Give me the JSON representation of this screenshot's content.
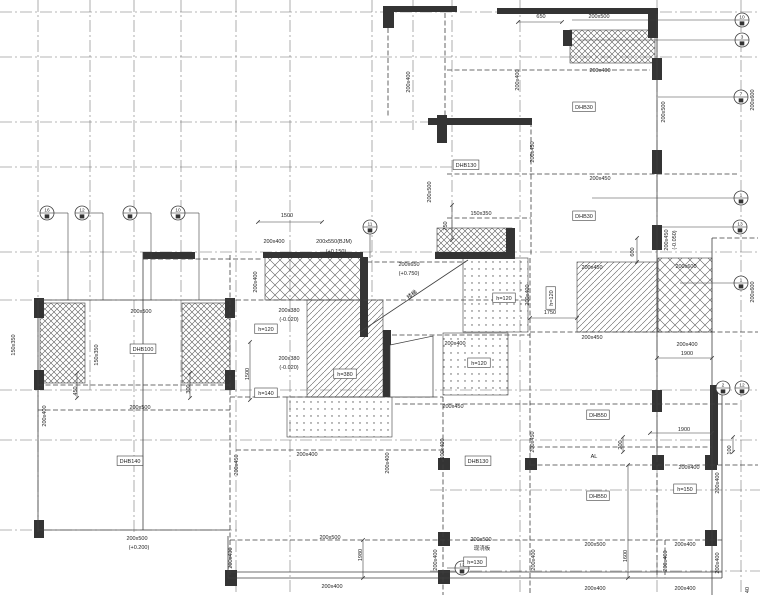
{
  "meta": {
    "kind": "structural-floor-plan",
    "width": 760,
    "height": 595
  },
  "colors": {
    "bg": "#ffffff",
    "ink": "#3f3f3f",
    "grid": "#6b6b6b",
    "dark": "#343434",
    "text": "#1f1f1f",
    "hatch": "#555555"
  },
  "drawing": {
    "grid_v": [
      [
        38,
        0,
        530
      ],
      [
        90,
        0,
        390
      ],
      [
        134,
        0,
        532
      ],
      [
        181,
        0,
        392
      ],
      [
        236,
        0,
        595
      ],
      [
        290,
        0,
        595
      ],
      [
        372,
        0,
        300
      ],
      [
        452,
        0,
        240
      ],
      [
        413,
        0,
        130
      ],
      [
        520,
        0,
        595
      ],
      [
        657,
        0,
        595
      ],
      [
        741,
        0,
        595
      ]
    ],
    "grid_h": [
      [
        12,
        0,
        760
      ],
      [
        57,
        0,
        760
      ],
      [
        122,
        0,
        435
      ],
      [
        167,
        0,
        455
      ],
      [
        252,
        0,
        760
      ],
      [
        300,
        0,
        240
      ],
      [
        390,
        0,
        760
      ],
      [
        440,
        0,
        760
      ],
      [
        490,
        430,
        760
      ],
      [
        530,
        0,
        240
      ],
      [
        571,
        430,
        760
      ]
    ],
    "hatch": [
      {
        "x": 570,
        "y": 30,
        "w": 85,
        "h": 33,
        "p": "xh"
      },
      {
        "x": 437,
        "y": 228,
        "w": 75,
        "h": 30,
        "p": "xh"
      },
      {
        "x": 40,
        "y": 303,
        "w": 45,
        "h": 80,
        "p": "xh"
      },
      {
        "x": 182,
        "y": 303,
        "w": 48,
        "h": 80,
        "p": "xh"
      },
      {
        "x": 265,
        "y": 257,
        "w": 98,
        "h": 43,
        "p": "dm"
      },
      {
        "x": 658,
        "y": 258,
        "w": 54,
        "h": 74,
        "p": "dm"
      },
      {
        "x": 577,
        "y": 262,
        "w": 80,
        "h": 70,
        "p": "dg"
      },
      {
        "x": 307,
        "y": 300,
        "w": 76,
        "h": 97,
        "p": "dg"
      },
      {
        "x": 463,
        "y": 258,
        "w": 65,
        "h": 74,
        "p": "st"
      },
      {
        "x": 443,
        "y": 333,
        "w": 65,
        "h": 62,
        "p": "st"
      },
      {
        "x": 287,
        "y": 397,
        "w": 105,
        "h": 40,
        "p": "st"
      }
    ],
    "dark_rects": [
      [
        497,
        8,
        161,
        6
      ],
      [
        383,
        6,
        74,
        6
      ],
      [
        383,
        6,
        11,
        22
      ],
      [
        437,
        115,
        10,
        28
      ],
      [
        428,
        118,
        104,
        7
      ],
      [
        506,
        228,
        9,
        30
      ],
      [
        435,
        252,
        80,
        7
      ],
      [
        263,
        252,
        100,
        6
      ],
      [
        143,
        252,
        52,
        7
      ],
      [
        360,
        257,
        8,
        80
      ],
      [
        383,
        330,
        8,
        67
      ],
      [
        652,
        58,
        10,
        22
      ],
      [
        652,
        150,
        10,
        24
      ],
      [
        652,
        225,
        10,
        25
      ],
      [
        648,
        8,
        10,
        30
      ],
      [
        563,
        30,
        9,
        16
      ],
      [
        34,
        298,
        10,
        20
      ],
      [
        34,
        370,
        10,
        20
      ],
      [
        34,
        520,
        10,
        18
      ],
      [
        225,
        298,
        10,
        20
      ],
      [
        225,
        370,
        10,
        20
      ],
      [
        225,
        570,
        12,
        16
      ],
      [
        438,
        458,
        12,
        12
      ],
      [
        525,
        458,
        12,
        12
      ],
      [
        652,
        455,
        12,
        15
      ],
      [
        705,
        455,
        12,
        15
      ],
      [
        438,
        532,
        12,
        14
      ],
      [
        705,
        530,
        12,
        16
      ],
      [
        652,
        390,
        10,
        22
      ],
      [
        710,
        385,
        8,
        80
      ],
      [
        438,
        570,
        12,
        14
      ]
    ],
    "dash_lines": [
      [
        388,
        28,
        388,
        118
      ],
      [
        445,
        13,
        445,
        118
      ],
      [
        447,
        70,
        650,
        70
      ],
      [
        447,
        174,
        738,
        174
      ],
      [
        531,
        122,
        531,
        256
      ],
      [
        447,
        218,
        531,
        218
      ],
      [
        143,
        259,
        263,
        259
      ],
      [
        230,
        255,
        230,
        578
      ],
      [
        38,
        385,
        230,
        385
      ],
      [
        38,
        410,
        230,
        410
      ],
      [
        236,
        300,
        530,
        300
      ],
      [
        230,
        397,
        443,
        397
      ],
      [
        392,
        335,
        530,
        335
      ],
      [
        395,
        404,
        738,
        404
      ],
      [
        443,
        397,
        443,
        595
      ],
      [
        530,
        258,
        530,
        595
      ],
      [
        530,
        447,
        712,
        447
      ],
      [
        530,
        465,
        758,
        465
      ],
      [
        236,
        450,
        443,
        450
      ],
      [
        230,
        540,
        722,
        540
      ],
      [
        657,
        465,
        657,
        578
      ],
      [
        665,
        540,
        665,
        578
      ],
      [
        712,
        238,
        758,
        238
      ],
      [
        530,
        332,
        758,
        332
      ],
      [
        367,
        262,
        463,
        262
      ]
    ],
    "solid_lines": [
      [
        38,
        300,
        230,
        300
      ],
      [
        38,
        300,
        38,
        532
      ],
      [
        38,
        530,
        230,
        530
      ],
      [
        143,
        252,
        143,
        530
      ],
      [
        228,
        572,
        722,
        572
      ],
      [
        228,
        578,
        722,
        578
      ],
      [
        712,
        238,
        712,
        595
      ],
      [
        722,
        390,
        722,
        578
      ],
      [
        657,
        14,
        657,
        462
      ],
      [
        228,
        536,
        228,
        578
      ],
      [
        360,
        332,
        468,
        260
      ]
    ],
    "polys": [
      {
        "pts": "390,345 433,336 433,397 390,397"
      }
    ],
    "dims": [
      [
        258,
        222,
        322,
        222
      ],
      [
        518,
        22,
        562,
        22
      ],
      [
        530,
        318,
        577,
        318
      ],
      [
        650,
        433,
        712,
        433
      ],
      [
        657,
        358,
        712,
        358
      ],
      [
        363,
        540,
        363,
        578
      ],
      [
        628,
        465,
        628,
        578
      ],
      [
        637,
        238,
        637,
        262
      ],
      [
        452,
        205,
        452,
        240
      ],
      [
        77,
        373,
        77,
        398
      ],
      [
        190,
        373,
        190,
        398
      ],
      [
        250,
        342,
        250,
        400
      ],
      [
        733,
        437,
        733,
        452
      ],
      [
        623,
        437,
        623,
        452
      ]
    ],
    "leaders": [
      [
        54,
        213,
        68,
        213
      ],
      [
        68,
        213,
        68,
        300
      ],
      [
        89,
        213,
        103,
        213
      ],
      [
        103,
        213,
        103,
        300
      ],
      [
        137,
        213,
        151,
        213
      ],
      [
        151,
        213,
        151,
        300
      ],
      [
        185,
        213,
        199,
        213
      ],
      [
        199,
        213,
        199,
        300
      ],
      [
        370,
        234,
        370,
        258
      ],
      [
        735,
        20,
        572,
        20
      ],
      [
        735,
        40,
        578,
        40
      ],
      [
        734,
        97,
        658,
        97
      ],
      [
        734,
        198,
        592,
        198
      ],
      [
        733,
        227,
        660,
        227
      ],
      [
        734,
        283,
        680,
        283
      ],
      [
        455,
        568,
        447,
        568
      ]
    ],
    "bubbles": [
      {
        "x": 47,
        "y": 213,
        "n": "16"
      },
      {
        "x": 82,
        "y": 213,
        "n": "12"
      },
      {
        "x": 130,
        "y": 213,
        "n": "8"
      },
      {
        "x": 178,
        "y": 213,
        "n": "10"
      },
      {
        "x": 370,
        "y": 227,
        "n": "11"
      },
      {
        "x": 742,
        "y": 20,
        "n": "10"
      },
      {
        "x": 742,
        "y": 40,
        "n": "3"
      },
      {
        "x": 741,
        "y": 97,
        "n": "7"
      },
      {
        "x": 741,
        "y": 198,
        "n": "1"
      },
      {
        "x": 740,
        "y": 227,
        "n": "13"
      },
      {
        "x": 741,
        "y": 283,
        "n": "1"
      },
      {
        "x": 723,
        "y": 388,
        "n": "2"
      },
      {
        "x": 742,
        "y": 388,
        "n": "12"
      },
      {
        "x": 462,
        "y": 568,
        "n": "12"
      }
    ],
    "labels": [
      {
        "t": "650",
        "x": 541,
        "y": 18
      },
      {
        "t": "200x500",
        "x": 599,
        "y": 18
      },
      {
        "t": "200x400",
        "x": 600,
        "y": 72
      },
      {
        "t": "200x400",
        "x": 519,
        "y": 80,
        "r": -90
      },
      {
        "t": "200x400",
        "x": 410,
        "y": 82,
        "r": -90
      },
      {
        "t": "200x500",
        "x": 665,
        "y": 112,
        "r": -90
      },
      {
        "t": "DHB30",
        "x": 584,
        "y": 109,
        "b": 1
      },
      {
        "t": "200x450",
        "x": 600,
        "y": 180
      },
      {
        "t": "200x450",
        "x": 534,
        "y": 152,
        "r": -90
      },
      {
        "t": "DHB130",
        "x": 466,
        "y": 167,
        "b": 1
      },
      {
        "t": "200x500",
        "x": 431,
        "y": 192,
        "r": -90
      },
      {
        "t": "DHB30",
        "x": 584,
        "y": 218,
        "b": 1
      },
      {
        "t": "150x350",
        "x": 481,
        "y": 215
      },
      {
        "t": "750",
        "x": 447,
        "y": 226,
        "r": -90
      },
      {
        "t": "200x600",
        "x": 754,
        "y": 100,
        "r": -90
      },
      {
        "t": "1500",
        "x": 287,
        "y": 217
      },
      {
        "t": "200x400",
        "x": 274,
        "y": 243
      },
      {
        "t": "200x550(BJM)",
        "x": 334,
        "y": 243
      },
      {
        "t": "(+0.150)",
        "x": 336,
        "y": 253
      },
      {
        "t": "200x400",
        "x": 257,
        "y": 282,
        "r": -90
      },
      {
        "t": "200x650",
        "x": 409,
        "y": 266
      },
      {
        "t": "(+0.750)",
        "x": 409,
        "y": 275
      },
      {
        "t": "楼梯",
        "x": 413,
        "y": 296,
        "r": -38
      },
      {
        "t": "200x450",
        "x": 592,
        "y": 269
      },
      {
        "t": "200x600",
        "x": 686,
        "y": 268
      },
      {
        "t": "200x450",
        "x": 668,
        "y": 240,
        "r": -90
      },
      {
        "t": "(-0.050)",
        "x": 676,
        "y": 240,
        "r": -90
      },
      {
        "t": "600",
        "x": 634,
        "y": 252,
        "r": -90
      },
      {
        "t": "h=120",
        "x": 504,
        "y": 300,
        "b": 1
      },
      {
        "t": "h=120",
        "x": 553,
        "y": 298,
        "r": -90,
        "b": 1
      },
      {
        "t": "200x400",
        "x": 529,
        "y": 295,
        "r": -90
      },
      {
        "t": "1750",
        "x": 550,
        "y": 314
      },
      {
        "t": "200x600",
        "x": 754,
        "y": 292,
        "r": -90
      },
      {
        "t": "200x380",
        "x": 289,
        "y": 312
      },
      {
        "t": "(-0.020)",
        "x": 289,
        "y": 321
      },
      {
        "t": "h=120",
        "x": 266,
        "y": 331,
        "b": 1
      },
      {
        "t": "200x380",
        "x": 289,
        "y": 360
      },
      {
        "t": "(-0.020)",
        "x": 289,
        "y": 369
      },
      {
        "t": "h=140",
        "x": 266,
        "y": 395,
        "b": 1
      },
      {
        "t": "h=380",
        "x": 345,
        "y": 376,
        "b": 1
      },
      {
        "t": "1500",
        "x": 249,
        "y": 374,
        "r": -90
      },
      {
        "t": "200x500",
        "x": 141,
        "y": 313
      },
      {
        "t": "150x350",
        "x": 98,
        "y": 355,
        "r": -90
      },
      {
        "t": "DHB100",
        "x": 143,
        "y": 351,
        "b": 1
      },
      {
        "t": "150x350",
        "x": 15,
        "y": 345,
        "r": -90
      },
      {
        "t": "450",
        "x": 77,
        "y": 391,
        "r": -90
      },
      {
        "t": "300",
        "x": 190,
        "y": 389,
        "r": -90
      },
      {
        "t": "200x500",
        "x": 140,
        "y": 409
      },
      {
        "t": "200x400",
        "x": 46,
        "y": 416,
        "r": -90
      },
      {
        "t": "200x400",
        "x": 455,
        "y": 345
      },
      {
        "t": "h=120",
        "x": 479,
        "y": 365,
        "b": 1
      },
      {
        "t": "200x450",
        "x": 453,
        "y": 408
      },
      {
        "t": "200x450",
        "x": 592,
        "y": 339
      },
      {
        "t": "200x400",
        "x": 687,
        "y": 346
      },
      {
        "t": "1900",
        "x": 687,
        "y": 355
      },
      {
        "t": "DHB50",
        "x": 598,
        "y": 417,
        "b": 1
      },
      {
        "t": "200x400",
        "x": 444,
        "y": 449,
        "r": -90
      },
      {
        "t": "1900",
        "x": 684,
        "y": 431
      },
      {
        "t": "100",
        "x": 731,
        "y": 450,
        "r": -90
      },
      {
        "t": "200",
        "x": 622,
        "y": 445,
        "r": -90
      },
      {
        "t": "AL",
        "x": 594,
        "y": 458
      },
      {
        "t": "200x450",
        "x": 534,
        "y": 442,
        "r": -90
      },
      {
        "t": "DHB130",
        "x": 478,
        "y": 463,
        "b": 1
      },
      {
        "t": "200x450",
        "x": 238,
        "y": 465,
        "r": -90
      },
      {
        "t": "200x400",
        "x": 307,
        "y": 456
      },
      {
        "t": "200x400",
        "x": 389,
        "y": 463,
        "r": -90
      },
      {
        "t": "DHB140",
        "x": 130,
        "y": 463,
        "b": 1
      },
      {
        "t": "200x400",
        "x": 689,
        "y": 469
      },
      {
        "t": "h=150",
        "x": 685,
        "y": 491,
        "b": 1
      },
      {
        "t": "200x400",
        "x": 719,
        "y": 483,
        "r": -90
      },
      {
        "t": "DHB50",
        "x": 598,
        "y": 498,
        "b": 1
      },
      {
        "t": "200x500",
        "x": 137,
        "y": 540
      },
      {
        "t": "(+0.200)",
        "x": 139,
        "y": 549
      },
      {
        "t": "200x400",
        "x": 232,
        "y": 558,
        "r": -90
      },
      {
        "t": "200x500",
        "x": 330,
        "y": 539
      },
      {
        "t": "1980",
        "x": 362,
        "y": 555,
        "r": -90
      },
      {
        "t": "200x400",
        "x": 332,
        "y": 588
      },
      {
        "t": "200x500",
        "x": 481,
        "y": 541
      },
      {
        "t": "现浇板",
        "x": 482,
        "y": 550
      },
      {
        "t": "h=130",
        "x": 475,
        "y": 564,
        "b": 1
      },
      {
        "t": "200x400",
        "x": 437,
        "y": 560,
        "r": -90
      },
      {
        "t": "200x500",
        "x": 595,
        "y": 546
      },
      {
        "t": "200x400",
        "x": 685,
        "y": 546
      },
      {
        "t": "1600",
        "x": 627,
        "y": 556,
        "r": -90
      },
      {
        "t": "200x400",
        "x": 535,
        "y": 560,
        "r": -90
      },
      {
        "t": "200x400",
        "x": 667,
        "y": 561,
        "r": -90
      },
      {
        "t": "200x400",
        "x": 719,
        "y": 563,
        "r": -90
      },
      {
        "t": "200x400",
        "x": 595,
        "y": 590
      },
      {
        "t": "200x400",
        "x": 685,
        "y": 590
      },
      {
        "t": "40",
        "x": 749,
        "y": 590,
        "r": -90
      }
    ]
  }
}
